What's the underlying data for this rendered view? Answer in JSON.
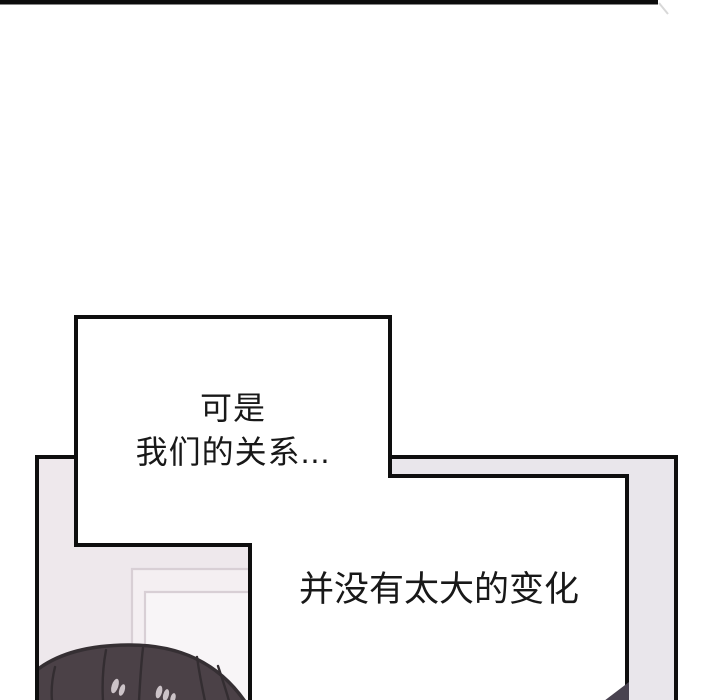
{
  "page": {
    "width": 720,
    "height": 700,
    "background": "#ffffff",
    "kind": "webtoon-comic-panel"
  },
  "speech_bubble": {
    "lines": [
      "可是",
      "我们的关系..."
    ]
  },
  "dialogue_panel": {
    "text": "并没有太大的变化"
  },
  "colors": {
    "ink": "#0e0e0e",
    "frame_gray": "#e9e6eb",
    "room_wall": "#eee8ec",
    "door_gap_fill": "#f4eff2",
    "door_inner_fill": "#f8f5f7",
    "door_line": "#d8cfd5",
    "hair_fill": "#4b4147",
    "hair_outline": "#352f33",
    "hair_strand": "#332d31",
    "hair_glint": "#ccc3c8",
    "corner_wedge": "#494350",
    "text_color": "#181818",
    "smudge": "#d8d8d8"
  }
}
